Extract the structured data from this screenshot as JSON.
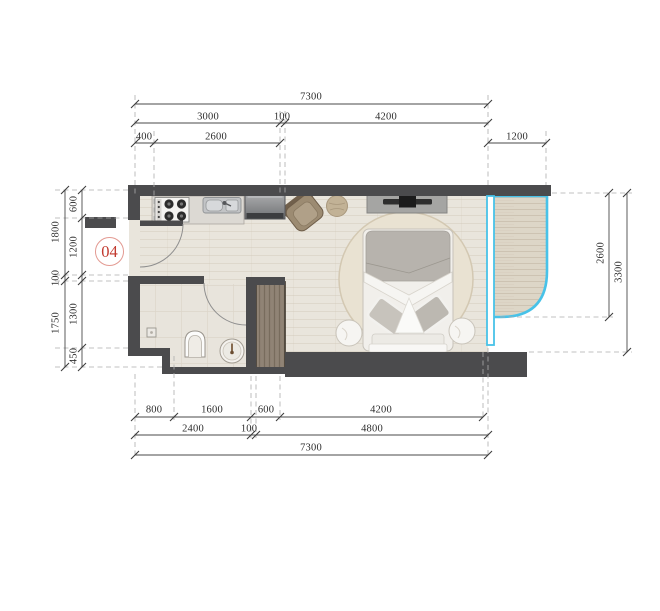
{
  "title": "Apartment unit floor plan",
  "unit": {
    "number": "04"
  },
  "dims": {
    "top_total": "7300",
    "top_3000": "3000",
    "top_100": "100",
    "top_4200": "4200",
    "top_400": "400",
    "top_2600": "2600",
    "top_balcony_1200": "1200",
    "left_outer_1800": "1800",
    "left_outer_100": "100",
    "left_outer_1750": "1750",
    "left_inner_600": "600",
    "left_inner_1200": "1200",
    "left_inner_1300": "1300",
    "left_inner_450": "450",
    "right_inner_2600": "2600",
    "right_outer_3300": "3300",
    "bottom_800": "800",
    "bottom_1600": "1600",
    "bottom_600": "600",
    "bottom_4200": "4200",
    "bottom_2400": "2400",
    "bottom_100": "100",
    "bottom_4800": "4800",
    "bottom_total": "7300"
  },
  "colors": {
    "wall": "#4b4b4d",
    "glass": "#48c2e8",
    "floor": "#e9e5dc",
    "balcony_floor": "#ddd6c7",
    "bath_floor": "#e8e4dc",
    "wardrobe_wood": "#8d8072",
    "unit_label_red": "#c2392e",
    "dim_text": "#2e2e2e"
  },
  "fixtures": {
    "kitchen": [
      "stove",
      "sink",
      "refrigerator"
    ],
    "bathroom": [
      "toilet",
      "washbasin",
      "floor-drain"
    ],
    "bedroom": [
      "bed",
      "rug",
      "nightstand-left",
      "nightstand-right",
      "tv-console",
      "armchair",
      "pouf",
      "wardrobe"
    ],
    "balcony": [
      "curved-glass-wall",
      "glass-partition"
    ]
  }
}
